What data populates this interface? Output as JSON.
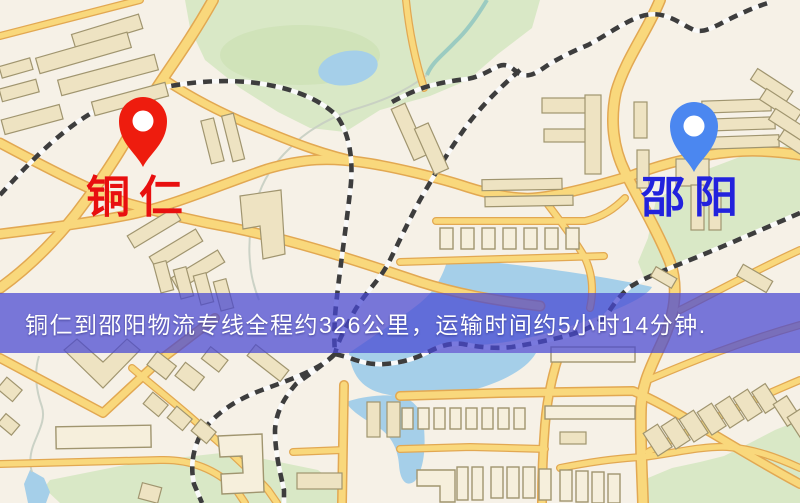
{
  "banner": {
    "text": "铜仁到邵阳物流专线全程约326公里，运输时间约5小时14分钟.",
    "bg": "rgba(70,70,210,0.72)",
    "text_color": "#ffffff"
  },
  "markers": {
    "origin": {
      "label": "铜仁",
      "pin_icon": "red-pin-icon",
      "pin_color": "#ee1c0e",
      "pin_inner_color": "#ffffff",
      "label_color": "#e80f0f"
    },
    "destination": {
      "label": "邵阳",
      "pin_icon": "blue-pin-icon",
      "pin_color": "#4b87f0",
      "pin_inner_color": "#ffffff",
      "label_color": "#2222dd"
    }
  },
  "map_colors": {
    "bg": "#f6f1e7",
    "road_fill": "#f9d87c",
    "road_casing": "#e2a852",
    "rail": "#3d3d3d",
    "rail_base": "#fafafa",
    "park": "#d9e8c6",
    "park_dark": "#c9deae",
    "water": "#a5cfe9",
    "building": "#eee3c2",
    "building_stroke": "#a0956f",
    "building_light": "#f6efdc",
    "stream": "#c6cec2",
    "stream_teal": "#8fc6bf"
  }
}
